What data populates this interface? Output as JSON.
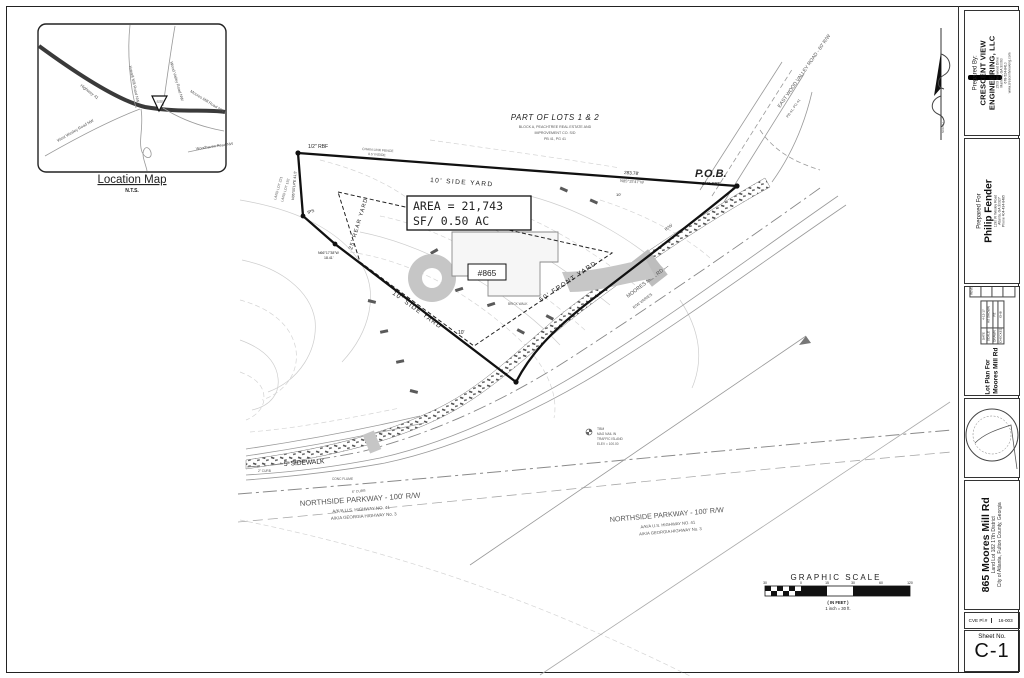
{
  "location_map": {
    "title": "Location Map",
    "nts": "N.T.S.",
    "site": "SITE",
    "roads": {
      "hw41": "Highway 41",
      "howell": "Howell Mill Road NW",
      "woodvalley": "Wood Valley Road NW",
      "moores1": "Moores Mill Road NW",
      "moores2": "Moores Mill Road NW",
      "westwesley": "West Wesley Road NW",
      "woodhaven": "Woodhaven Road NW"
    }
  },
  "drawing": {
    "lots_note": {
      "title": "PART OF LOTS 1 & 2",
      "l1": "BLOCK A, PEACHTREE REAL ESTATE AND",
      "l2": "IMPROVEMENT CO. S/D",
      "l3": "PB 41, PG 41"
    },
    "area": {
      "l1": "AREA = 21,743",
      "l2": "SF/ 0.50 AC"
    },
    "pob": {
      "label": "P.O.B.",
      "mon": "1/4\" RBF"
    },
    "mon_rbf": "1/2\" RBF",
    "mon_ips": "IPS",
    "fence": {
      "l1": "CHAIN LINK FENCE",
      "l2": "0.5' INSIDE"
    },
    "dim_top": {
      "dist": "283.78'",
      "brg": "N85°15'47\"W"
    },
    "dim_west": "N05°55'14\"E  41.5'",
    "dim_jog": {
      "brg": "N66°17'38\"W",
      "dist": "18.41'"
    },
    "landlot": {
      "l1": "LAND LOT 221",
      "l2": "LAND LOT 192"
    },
    "setbacks": {
      "top": "10' SIDE YARD",
      "rear": "25' REAR YARD",
      "bottom": "10' SIDE YARD",
      "front": "50' FRONT YARD",
      "ten1": "10'",
      "ten2": "10'"
    },
    "house": {
      "number": "#865",
      "wall": "BRICK WALL",
      "walk": "BRICK WALK"
    },
    "roads": {
      "mm_name": "MOORES MILL RD —",
      "mm_rw": "R/W VARIES",
      "rw": "R/W",
      "sidewalk": "5'  SIDEWALK",
      "ewv": "EAST WOOD VALLEY ROAD - 60' R/W",
      "ewv_ref": "PB 41, PG 41",
      "ns": "NORTHSIDE PARKWAY - 100' R/W",
      "aka1": "A/K/A U.S. HIGHWAY NO. 41",
      "aka2": "A/K/A GEORGIA HIGHWAY No. 3",
      "curb6": "6\" CURB",
      "curb2": "2\" CURB",
      "flume": "CONC FLUME"
    },
    "tbm": {
      "l1": "TBM",
      "l2": "MAG NAIL IN",
      "l3": "TRAFFIC ISLAND",
      "l4": "ELEV = 100.00"
    },
    "scale": {
      "title": "GRAPHIC SCALE",
      "feet": "( IN FEET )",
      "ratio": "1 inch = 30 ft.",
      "ticks": [
        "30",
        "0",
        "15",
        "30",
        "60",
        "120"
      ]
    },
    "north": "NORTH"
  },
  "title_block": {
    "prepared_by": {
      "label": "Prepared By:",
      "co1": "CRESCENT VIEW",
      "co2": "ENGINEERING, LLC",
      "a1": "1503 Kenwood Drive",
      "a2": "Marietta, GA 30060",
      "a3": "678-524-8410",
      "a4": "www.crescentvieweng.com"
    },
    "prepared_for": {
      "label": "Prepared For",
      "name": "Philip Fender",
      "a1": "1190 W Wesley Road",
      "a2": "Atlanta, GA 30327",
      "a3": "Phone 404-434-8485"
    },
    "plan": {
      "l1": "Lot Plan For",
      "l2": "865 Moores Mill Rd"
    },
    "table": {
      "date_l": "DATE",
      "date_v": "4-12-17",
      "scale_l": "SCALE",
      "scale_v": "AS SHOWN",
      "drawn_l": "DRAWN",
      "drawn_v": "PZ",
      "checked_l": "CHECKED",
      "checked_v": "GHB",
      "revisions": "REVISIONS"
    },
    "project": {
      "name": "865 Moores Mill Rd",
      "l1": "Land Lot 182 17th District",
      "l2": "City of Atlanta, Fulton County, Georgia"
    },
    "cve": {
      "label": "CVE Pl.#",
      "value": "16-003"
    },
    "sheet": {
      "label": "Sheet No.",
      "number": "C-1"
    }
  }
}
